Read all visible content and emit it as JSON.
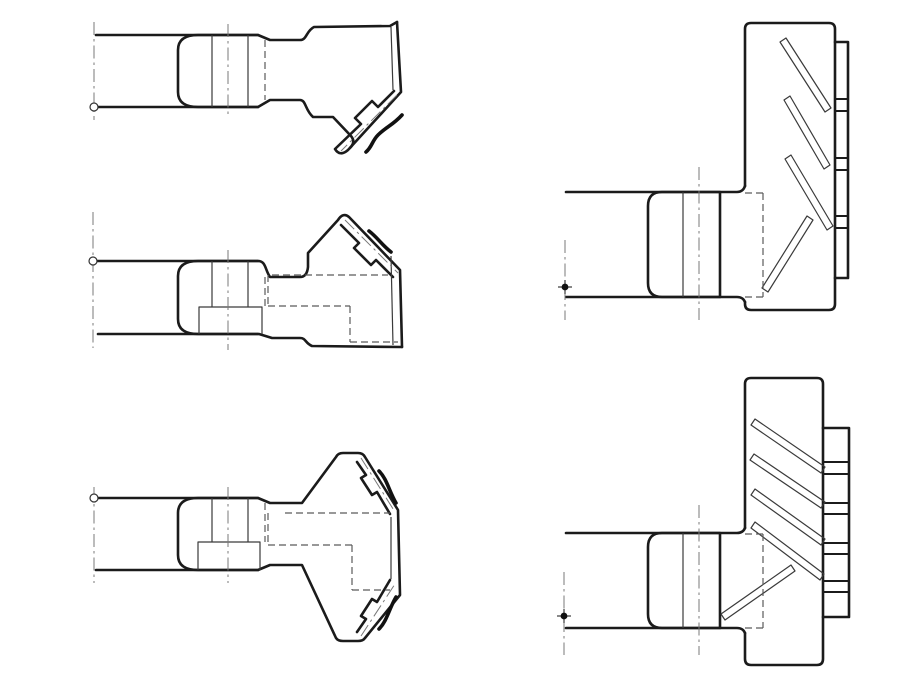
{
  "document": {
    "kind": "engineering-line-drawing",
    "description": "Five orthographic views of bevel pinion / gear blank machining stages, no text labels",
    "background": "#ffffff",
    "canvas": {
      "width": 913,
      "height": 684
    },
    "colors": {
      "outline": "#1b1b1b",
      "thin_line": "#3a3a3a",
      "hidden_line": "#5a5a5a",
      "centerline": "#787878",
      "break_line": "#111111",
      "paper": "#ffffff"
    }
  },
  "drawing": {
    "views": [
      {
        "id": "view-pinion-stage-1",
        "label": "top-left side view, bevel flank lower right",
        "paths": [
          {
            "name": "outline-top",
            "style": "thick",
            "d": "M96,35 L258,35 L270,40 L300,40 C307,40 306,31 314,27 L390,26 L397,22"
          },
          {
            "name": "outline-rim-and-flank",
            "style": "thick",
            "d": "M397,22 L401,92 L348,150 Q340,157 335,149 L361,124 L355,118 L372,101 L378,107 L394,91"
          },
          {
            "name": "outline-bottom",
            "style": "thick",
            "d": "M98,107 L258,107 L270,100 L300,100 C306,100 305,110 313,117 L333,117 L351,136 Q356,142 350,148"
          },
          {
            "name": "journal-sleeve",
            "style": "thick",
            "d": "M258,35 L198,35 Q178,35 178,50 L178,92 Q178,107 198,107 L258,107"
          },
          {
            "name": "sleeve-line-left",
            "style": "thin",
            "d": "M212,35 L212,107"
          },
          {
            "name": "sleeve-line-right",
            "style": "thin",
            "d": "M248,35 L248,107"
          },
          {
            "name": "rim-inner-line",
            "style": "thin",
            "d": "M391,27 L393,90"
          },
          {
            "name": "hidden-step-line",
            "style": "dash",
            "d": "M265,40 L265,100"
          },
          {
            "name": "journal-centerline",
            "style": "dashdot",
            "d": "M228,24 L228,118"
          },
          {
            "name": "axis-centerline",
            "style": "dashdot",
            "d": "M94,22 L94,120"
          },
          {
            "name": "flank-centerline",
            "style": "dashdot",
            "d": "M397,95 L341,151"
          },
          {
            "name": "break-line",
            "style": "wavy",
            "d": "M402,115 C393,125 386,127 378,135 C372,141 372,147 366,152"
          }
        ],
        "circles": [
          {
            "name": "axis-marker",
            "style": "marker-open",
            "cx": 94,
            "cy": 107,
            "r": 4
          }
        ]
      },
      {
        "id": "view-pinion-stage-2",
        "label": "middle-left side view, bevel flank upper right, hidden bore",
        "paths": [
          {
            "name": "outline-top",
            "style": "thick",
            "d": "M96,261 L258,261 C266,261 265,270 270,277 L300,277 Q307,277 308,267 L308,253 L338,220 Q343,212 349,217 L400,270 L402,347"
          },
          {
            "name": "outline-bottom",
            "style": "thick",
            "d": "M98,334 L259,334 L272,338 L300,338 C306,338 305,343 312,346 L402,347"
          },
          {
            "name": "flank-inner-line",
            "style": "thick",
            "d": "M341,225 L359,243 L354,248 L371,265 L376,260 L393,277"
          },
          {
            "name": "journal-sleeve",
            "style": "thick",
            "d": "M258,261 L198,261 Q178,261 178,276 L178,319 Q178,334 198,334 L258,334"
          },
          {
            "name": "hub-rect",
            "style": "thin",
            "d": "M199,334 L199,307 L262,307 L262,334"
          },
          {
            "name": "sleeve-line-left",
            "style": "thin",
            "d": "M212,261 L212,307"
          },
          {
            "name": "sleeve-line-right",
            "style": "thin",
            "d": "M248,261 L248,307"
          },
          {
            "name": "rim-inner-line",
            "style": "thin",
            "d": "M391,256 L393,345"
          },
          {
            "name": "hidden-step-line",
            "style": "dash",
            "d": "M265,277 L265,306"
          },
          {
            "name": "hidden-bore-top",
            "style": "dash",
            "d": "M272,275 L388,275"
          },
          {
            "name": "hidden-bore-left",
            "style": "dash",
            "d": "M268,275 L268,306"
          },
          {
            "name": "hidden-bore-mid",
            "style": "dash",
            "d": "M268,306 L350,306"
          },
          {
            "name": "hidden-bore-vert",
            "style": "dash",
            "d": "M350,306 L350,342"
          },
          {
            "name": "hidden-bore-bottom",
            "style": "dash",
            "d": "M350,342 L398,342"
          },
          {
            "name": "journal-centerline",
            "style": "dashdot",
            "d": "M228,250 L228,350"
          },
          {
            "name": "axis-centerline",
            "style": "dashdot",
            "d": "M93,212 L93,348"
          },
          {
            "name": "flank-centerline",
            "style": "dashdot",
            "d": "M345,220 L398,273"
          },
          {
            "name": "break-line",
            "style": "wavy",
            "d": "M369,231 C378,238 381,244 391,252"
          }
        ],
        "circles": [
          {
            "name": "axis-marker",
            "style": "marker-open",
            "cx": 93,
            "cy": 261,
            "r": 4
          }
        ]
      },
      {
        "id": "view-pinion-stage-3",
        "label": "bottom-left full symmetric view with both bevel flanks",
        "paths": [
          {
            "name": "outline-silhouette",
            "style": "thick",
            "d": "M96,498 L258,498 L270,503 L302,503 L336,457 Q338,453 343,453 L358,453 Q363,453 365,457 L398,510 L400,595 L365,638 Q363,641 358,641 L343,641 Q338,641 336,638 L302,565 L270,565 L258,570 L96,570"
          },
          {
            "name": "flank-inner-top",
            "style": "thick",
            "d": "M357,462 L366,475 L361,478 L372,495 L377,492 L390,514"
          },
          {
            "name": "flank-inner-bottom",
            "style": "thick",
            "d": "M357,632 L366,619 L361,616 L372,599 L377,602 L390,580"
          },
          {
            "name": "journal-sleeve",
            "style": "thick",
            "d": "M258,498 L198,498 Q178,498 178,513 L178,555 Q178,570 198,570 L258,570"
          },
          {
            "name": "hub-rect",
            "style": "thin",
            "d": "M198,570 L198,542 L260,542 L260,570"
          },
          {
            "name": "sleeve-line-left",
            "style": "thin",
            "d": "M212,498 L212,542"
          },
          {
            "name": "sleeve-line-right",
            "style": "thin",
            "d": "M248,498 L248,542"
          },
          {
            "name": "rim-inner-line",
            "style": "thin",
            "d": "M391,517 L391,579"
          },
          {
            "name": "hidden-step-line",
            "style": "dash",
            "d": "M265,503 L265,542"
          },
          {
            "name": "hidden-bore-1",
            "style": "dash",
            "d": "M285,513 L390,513"
          },
          {
            "name": "hidden-bore-2",
            "style": "dash",
            "d": "M268,513 L268,545"
          },
          {
            "name": "hidden-bore-3",
            "style": "dash",
            "d": "M268,545 L352,545"
          },
          {
            "name": "hidden-bore-4",
            "style": "dash",
            "d": "M352,545 L352,590"
          },
          {
            "name": "hidden-bore-5",
            "style": "dash",
            "d": "M352,590 L390,590"
          },
          {
            "name": "journal-centerline",
            "style": "dashdot",
            "d": "M228,487 L228,583"
          },
          {
            "name": "axis-centerline",
            "style": "dashdot",
            "d": "M94,487 L94,583"
          },
          {
            "name": "flank-centerline-top",
            "style": "dashdot",
            "d": "M361,458 L395,512"
          },
          {
            "name": "flank-centerline-bottom",
            "style": "dashdot",
            "d": "M361,636 L395,584"
          },
          {
            "name": "break-line-top",
            "style": "wavy",
            "d": "M379,471 C387,479 389,491 396,503"
          },
          {
            "name": "break-line-bottom",
            "style": "wavy",
            "d": "M379,629 C387,621 389,609 396,597"
          }
        ],
        "circles": [
          {
            "name": "axis-marker",
            "style": "marker-open",
            "cx": 94,
            "cy": 498,
            "r": 4
          }
        ]
      },
      {
        "id": "view-gear-flange-1",
        "label": "top-right flange view with four angled tool slots and tooth strip",
        "paths": [
          {
            "name": "shaft-top",
            "style": "thick",
            "d": "M566,192 L737,192 Q743,192 745,186"
          },
          {
            "name": "shaft-bottom",
            "style": "thick",
            "d": "M566,297 L737,297 Q743,297 745,302"
          },
          {
            "name": "flange-outline",
            "style": "thick",
            "d": "M745,186 L745,29 Q745,23 751,23 L829,23 Q835,23 835,29 L835,304 Q835,310 829,310 L751,310 Q745,310 745,304 L745,302"
          },
          {
            "name": "journal-sleeve",
            "style": "thick",
            "d": "M720,192 L662,192 Q648,192 648,206 L648,283 Q648,297 662,297 L720,297 L720,192"
          },
          {
            "name": "sleeve-line",
            "style": "thin",
            "d": "M683,192 L683,297"
          },
          {
            "name": "tooth-strip",
            "style": "thick",
            "d": "M835,42 L848,42 L848,278 L835,278"
          },
          {
            "name": "strip-divider-1",
            "style": "thick2",
            "d": "M835,99 L848,99"
          },
          {
            "name": "strip-divider-2",
            "style": "thick2",
            "d": "M835,111 L848,111"
          },
          {
            "name": "strip-divider-3",
            "style": "thick2",
            "d": "M835,158 L848,158"
          },
          {
            "name": "strip-divider-4",
            "style": "thick2",
            "d": "M835,170 L848,170"
          },
          {
            "name": "strip-divider-5",
            "style": "thick2",
            "d": "M835,216 L848,216"
          },
          {
            "name": "strip-divider-6",
            "style": "thick2",
            "d": "M835,228 L848,228"
          },
          {
            "name": "tooth-slot-1",
            "style": "thin",
            "d": "M780,42 L825,112 L831,108 L786,38 Z"
          },
          {
            "name": "tooth-slot-2",
            "style": "thin",
            "d": "M784,100 L824,169 L830,165 L790,96 Z"
          },
          {
            "name": "tooth-slot-3",
            "style": "thin",
            "d": "M785,159 L827,230 L833,226 L791,155 Z"
          },
          {
            "name": "tooth-slot-4",
            "style": "thin",
            "d": "M768,292 L813,220 L807,216 L762,288 Z"
          },
          {
            "name": "hidden-socket-top",
            "style": "dash",
            "d": "M745,193 L763,193"
          },
          {
            "name": "hidden-socket-vert",
            "style": "dash",
            "d": "M763,193 L763,297"
          },
          {
            "name": "hidden-socket-bottom",
            "style": "dash",
            "d": "M745,297 L763,297"
          },
          {
            "name": "journal-centerline",
            "style": "dashdot",
            "d": "M699,167 L699,320"
          },
          {
            "name": "axis-centerline",
            "style": "dashdot",
            "d": "M565,240 L565,320"
          },
          {
            "name": "datum-tick-h",
            "style": "thin",
            "d": "M558,287 L572,287"
          },
          {
            "name": "datum-tick-v",
            "style": "thin",
            "d": "M565,280 L565,294"
          }
        ],
        "circles": [
          {
            "name": "datum-dot",
            "style": "marker-dot",
            "cx": 565,
            "cy": 287,
            "r": 3.4
          }
        ]
      },
      {
        "id": "view-gear-flange-2",
        "label": "bottom-right flange view with five angled tool slots and tooth strip",
        "paths": [
          {
            "name": "shaft-top",
            "style": "thick",
            "d": "M566,533 L737,533 Q743,533 745,528"
          },
          {
            "name": "shaft-bottom",
            "style": "thick",
            "d": "M566,628 L737,628 Q743,628 745,633"
          },
          {
            "name": "flange-outline",
            "style": "thick",
            "d": "M745,528 L745,384 Q745,378 751,378 L817,378 Q823,378 823,384 L823,659 Q823,665 817,665 L751,665 Q745,665 745,659 L745,633"
          },
          {
            "name": "journal-sleeve",
            "style": "thick",
            "d": "M720,533 L662,533 Q648,533 648,547 L648,614 Q648,628 662,628 L720,628 L720,533"
          },
          {
            "name": "sleeve-line",
            "style": "thin",
            "d": "M683,533 L683,628"
          },
          {
            "name": "tooth-strip",
            "style": "thick",
            "d": "M823,428 L849,428 L849,617 L823,617"
          },
          {
            "name": "strip-divider-1",
            "style": "thick2",
            "d": "M823,462 L849,462"
          },
          {
            "name": "strip-divider-2",
            "style": "thick2",
            "d": "M823,474 L849,474"
          },
          {
            "name": "strip-divider-3",
            "style": "thick2",
            "d": "M823,503 L849,503"
          },
          {
            "name": "strip-divider-4",
            "style": "thick2",
            "d": "M823,514 L849,514"
          },
          {
            "name": "strip-divider-5",
            "style": "thick2",
            "d": "M823,543 L849,543"
          },
          {
            "name": "strip-divider-6",
            "style": "thick2",
            "d": "M823,554 L849,554"
          },
          {
            "name": "strip-divider-7",
            "style": "thick2",
            "d": "M823,581 L849,581"
          },
          {
            "name": "strip-divider-8",
            "style": "thick2",
            "d": "M823,592 L849,592"
          },
          {
            "name": "tooth-slot-1",
            "style": "thin",
            "d": "M751,425 L821,473 L825,467 L755,419 Z"
          },
          {
            "name": "tooth-slot-2",
            "style": "thin",
            "d": "M750,460 L821,508 L825,502 L754,454 Z"
          },
          {
            "name": "tooth-slot-3",
            "style": "thin",
            "d": "M751,495 L821,545 L825,539 L755,489 Z"
          },
          {
            "name": "tooth-slot-4",
            "style": "thin",
            "d": "M751,528 L820,580 L824,574 L755,522 Z"
          },
          {
            "name": "tooth-slot-5",
            "style": "thin",
            "d": "M725,620 L795,571 L791,565 L721,614 Z"
          },
          {
            "name": "hidden-socket-top",
            "style": "dash",
            "d": "M745,534 L763,534"
          },
          {
            "name": "hidden-socket-vert",
            "style": "dash",
            "d": "M763,534 L763,628"
          },
          {
            "name": "hidden-socket-bottom",
            "style": "dash",
            "d": "M745,628 L763,628"
          },
          {
            "name": "journal-centerline",
            "style": "dashdot",
            "d": "M699,505 L699,655"
          },
          {
            "name": "axis-centerline",
            "style": "dashdot",
            "d": "M564,572 L564,655"
          },
          {
            "name": "datum-tick-h",
            "style": "thin",
            "d": "M557,616 L571,616"
          },
          {
            "name": "datum-tick-v",
            "style": "thin",
            "d": "M564,609 L564,623"
          }
        ],
        "circles": [
          {
            "name": "datum-dot",
            "style": "marker-dot",
            "cx": 564,
            "cy": 616,
            "r": 3.4
          }
        ]
      }
    ]
  }
}
